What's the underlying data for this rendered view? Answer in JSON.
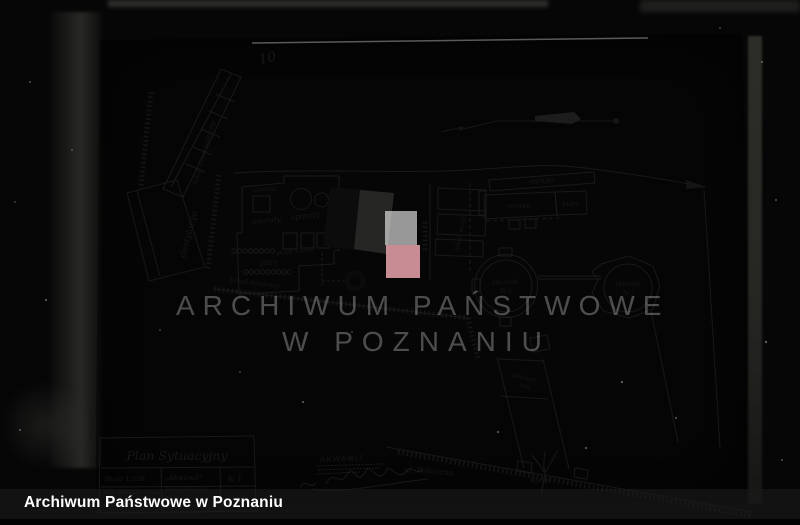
{
  "photo": {
    "page_number": "10",
    "watermark": {
      "line1": "ARCHIWUM PAŃSTWOWE",
      "line2": "W POZNANIU"
    },
    "footer_caption": "Archiwum Państwowe w Poznaniu"
  },
  "title_block": {
    "title": "Plan Sytuacyjny",
    "scale": "Skala 1:250",
    "drawn_label": "Rys.",
    "company_line1": "„Akwawit”",
    "company_line2": "Rektyfikacya",
    "company_line3": "Fama",
    "sheet_no": "№ 1",
    "sheet_no_sub": "8/41"
  },
  "plan_labels": {
    "rented_premises": "lokal dzierżawiony",
    "distillery": "destylacya",
    "laboratory": "laborat.",
    "apparatus_upper": "aparaty",
    "apparatus_lower": "aparaty",
    "filters": "filtry",
    "spirit_store": "skład wódek",
    "sewer_channel": "kanał ściekowy",
    "scale_house": "lokal wagi",
    "ramp_upper": "rampa",
    "ramp_lower": "rampa",
    "office": "bióro",
    "tank1_name": "zbiornik",
    "tank1_no": "№ 1",
    "tank2_name": "zbiornik",
    "tank2_no": "№ 2",
    "cooperage_line1": "bednar-",
    "cooperage_line2": "nia",
    "stamp_text": "AKWAWIT",
    "street_name": "ul. Północna",
    "entrance": "wjazd"
  },
  "colors": {
    "paper": "#a2a29a",
    "ink": "#1d1d1d",
    "watermark_square_pink": "#eba6ae",
    "watermark_square_white": "#fafafa",
    "footer_bar": "rgba(28,28,28,0.58)"
  }
}
